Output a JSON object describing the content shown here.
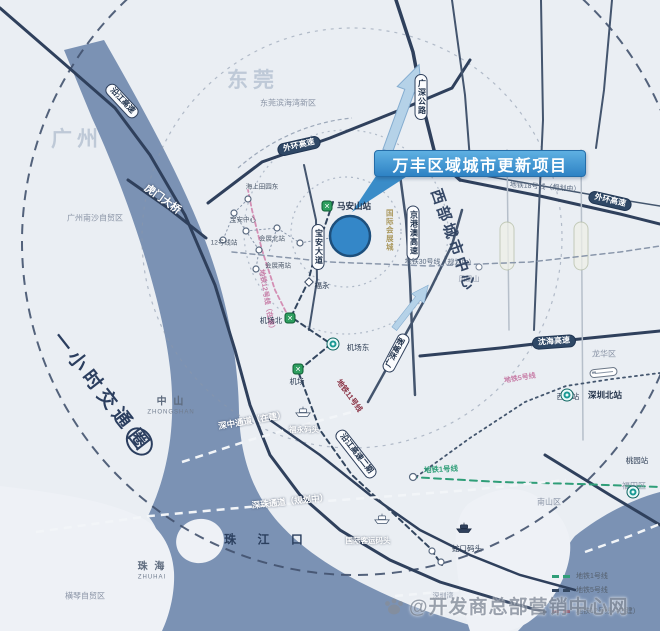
{
  "banner": {
    "title": "万丰区域城市更新项目"
  },
  "hour_circle": {
    "prefix": "一小时交通",
    "circled": "圈"
  },
  "legend": {
    "items": [
      {
        "label": "地铁1号线",
        "color": "#2f9e78"
      },
      {
        "label": "地铁5号线",
        "color": "#33465f"
      },
      {
        "label": "地铁12号线（在建）",
        "color": "#8a5a70"
      }
    ]
  },
  "watermark": {
    "text": "@开发商总部营销中心网",
    "icon": "baidu-paw-icon"
  },
  "palette": {
    "water": "#7b92b4",
    "land": "#eaeef3",
    "road": "#2f405c",
    "banner_blue": "#2e82c4",
    "project_circle_blue": "#3487c8",
    "metro_green": "#2e9e5f",
    "metro_teal": "#1a9a94",
    "line1_green": "#2f9e78",
    "line5_navy": "#33465f",
    "line11_maroon": "#8a3244",
    "line12_pink": "#d48fb4"
  },
  "map_labels": [
    {
      "name": "label-yanjiang-expressway",
      "text": "沿江高速",
      "x": 122,
      "y": 101,
      "rot": 47,
      "cls": "pillw"
    },
    {
      "name": "label-guangshen-highway",
      "text": "广深公路",
      "x": 421,
      "y": 97,
      "rot": 0,
      "cls": "pillv"
    },
    {
      "name": "label-jinggangao-expressway",
      "text": "京港澳高速",
      "x": 413,
      "y": 233,
      "rot": 0,
      "cls": "pillv"
    },
    {
      "name": "label-baoan-avenue",
      "text": "宝安大道",
      "x": 318,
      "y": 247,
      "rot": 0,
      "cls": "pillv"
    },
    {
      "name": "label-guangshen-expressway",
      "text": "广深高速",
      "x": 396,
      "y": 353,
      "rot": -62,
      "cls": "pillw"
    },
    {
      "name": "label-yanjiang-expressway-phase2",
      "text": "沿江高速二期",
      "x": 356,
      "y": 454,
      "rot": 52,
      "cls": "pillw"
    },
    {
      "name": "label-outer-ring-expressway-west",
      "text": "外环高速",
      "x": 299,
      "y": 146,
      "rot": -13,
      "cls": "pilld"
    },
    {
      "name": "label-outer-ring-expressway-east",
      "text": "外环高速",
      "x": 610,
      "y": 201,
      "rot": 13,
      "cls": "pilld"
    },
    {
      "name": "label-shenhai-expressway",
      "text": "沈海高速",
      "x": 554,
      "y": 342,
      "rot": -4,
      "cls": "pilld"
    },
    {
      "name": "label-humen-bridge",
      "text": "虎门大桥",
      "x": 162,
      "y": 200,
      "rot": 36,
      "cls": "wtext"
    },
    {
      "name": "label-shenzhong-corridor",
      "text": "深中通道（在建）",
      "x": 252,
      "y": 421,
      "rot": -10,
      "cls": "wtext-sm"
    },
    {
      "name": "label-shenzhu-corridor",
      "text": "深珠通道（规划中）",
      "x": 290,
      "y": 502,
      "rot": -6,
      "cls": "wtext-sm"
    },
    {
      "name": "label-fuyong-ferry",
      "text": "福永码头",
      "x": 304,
      "y": 430,
      "rot": 0,
      "cls": "wtext-xs"
    },
    {
      "name": "label-intl-ferry-terminal",
      "text": "国际客运码头",
      "x": 368,
      "y": 541,
      "rot": 0,
      "cls": "wtext-xs"
    },
    {
      "name": "label-pearl-river-estuary",
      "text": "珠 江 口",
      "x": 268,
      "y": 540,
      "rot": 0,
      "cls": "estuary"
    },
    {
      "name": "label-dongguan",
      "text": "东莞",
      "x": 253,
      "y": 81,
      "rot": 0,
      "cls": "citywm"
    },
    {
      "name": "label-guangzhou",
      "text": "广州",
      "x": 77,
      "y": 140,
      "rot": 0,
      "cls": "citywm"
    },
    {
      "name": "label-dg-binhaiwan-new-area",
      "text": "东莞滨海湾新区",
      "x": 288,
      "y": 104,
      "rot": 0,
      "cls": "region"
    },
    {
      "name": "label-gz-nansha-ftz",
      "text": "广州南沙自贸区",
      "x": 95,
      "y": 219,
      "rot": 0,
      "cls": "region"
    },
    {
      "name": "label-nanshan-district",
      "text": "南山区",
      "x": 549,
      "y": 503,
      "rot": 0,
      "cls": "region"
    },
    {
      "name": "label-futian-district",
      "text": "福田区",
      "x": 634,
      "y": 487,
      "rot": 0,
      "cls": "region"
    },
    {
      "name": "label-longhua-district",
      "text": "龙华区",
      "x": 604,
      "y": 355,
      "rot": 0,
      "cls": "region"
    },
    {
      "name": "label-hengqin-ftz",
      "text": "横琴自贸区",
      "x": 85,
      "y": 597,
      "rot": 0,
      "cls": "region"
    },
    {
      "name": "label-shenzhen-bay",
      "text": "深圳湾",
      "x": 443,
      "y": 597,
      "rot": 0,
      "cls": "region-xs"
    },
    {
      "name": "label-fenghuang-mountain",
      "text": "凤凰山",
      "x": 469,
      "y": 280,
      "rot": 0,
      "cls": "region-xs"
    },
    {
      "name": "label-zhongshan",
      "text": "中 山",
      "x": 171,
      "y": 402,
      "rot": 0,
      "cls": "city"
    },
    {
      "name": "label-zhongshan-en",
      "text": "ZHONGSHAN",
      "x": 171,
      "y": 413,
      "rot": 0,
      "cls": "city-sub"
    },
    {
      "name": "label-zhuhai",
      "text": "珠 海",
      "x": 152,
      "y": 567,
      "rot": 0,
      "cls": "city"
    },
    {
      "name": "label-zhuhai-en",
      "text": "ZHUHAI",
      "x": 152,
      "y": 578,
      "rot": 0,
      "cls": "city-sub"
    },
    {
      "name": "label-metro-line18",
      "text": "地铁18号线（规划中）",
      "x": 545,
      "y": 188,
      "rot": 4,
      "cls": "mline"
    },
    {
      "name": "label-metro-line30",
      "text": "地铁30号线（规划中）",
      "x": 440,
      "y": 263,
      "rot": 1,
      "cls": "mline"
    },
    {
      "name": "label-west-city-center",
      "text": "西部城市中心",
      "x": 452,
      "y": 241,
      "rot": 71,
      "cls": "bignavy"
    },
    {
      "name": "label-metro-line12",
      "text": "地铁12号线（在建）",
      "x": 266,
      "y": 301,
      "rot": 80,
      "cls": "mpink"
    },
    {
      "name": "label-metro-line11",
      "text": "地铁11号线",
      "x": 349,
      "y": 396,
      "rot": 54,
      "cls": "mmaroon"
    },
    {
      "name": "label-metro-line5",
      "text": "地铁5号线",
      "x": 520,
      "y": 379,
      "rot": -9,
      "cls": "mpink"
    },
    {
      "name": "label-metro-line1",
      "text": "地铁1号线",
      "x": 441,
      "y": 470,
      "rot": -3,
      "cls": "mgreen"
    },
    {
      "name": "label-maanshan-station",
      "text": "马安山站",
      "x": 354,
      "y": 207,
      "rot": 0,
      "cls": "sta-b"
    },
    {
      "name": "label-fuyong-station",
      "text": "福永",
      "x": 322,
      "y": 286,
      "rot": 0,
      "cls": "sta"
    },
    {
      "name": "label-airport-north-station",
      "text": "机场北",
      "x": 271,
      "y": 321,
      "rot": 0,
      "cls": "sta"
    },
    {
      "name": "label-airport-east-station",
      "text": "机场东",
      "x": 358,
      "y": 348,
      "rot": 0,
      "cls": "sta"
    },
    {
      "name": "label-airport-station",
      "text": "机场",
      "x": 297,
      "y": 382,
      "rot": 0,
      "cls": "sta"
    },
    {
      "name": "label-xili-station",
      "text": "西丽站",
      "x": 568,
      "y": 397,
      "rot": 0,
      "cls": "sta"
    },
    {
      "name": "label-shenzhen-north-station",
      "text": "深圳北站",
      "x": 605,
      "y": 396,
      "rot": 0,
      "cls": "sta-b"
    },
    {
      "name": "label-taoyuan-station",
      "text": "桃园站",
      "x": 637,
      "y": 461,
      "rot": 0,
      "cls": "sta"
    },
    {
      "name": "label-shekou-ferry",
      "text": "蛇口码头",
      "x": 467,
      "y": 549,
      "rot": 0,
      "cls": "sta"
    },
    {
      "name": "label-haishang-tianyuan-east",
      "text": "海上田园东",
      "x": 262,
      "y": 187,
      "rot": 0,
      "cls": "sta-xs"
    },
    {
      "name": "label-huizhan-north-station",
      "text": "会展北站",
      "x": 272,
      "y": 239,
      "rot": 0,
      "cls": "sta-xs"
    },
    {
      "name": "label-huizhan-south-station",
      "text": "会展南站",
      "x": 278,
      "y": 266,
      "rot": 0,
      "cls": "sta-xs"
    },
    {
      "name": "label-baoan-center",
      "text": "宝安中心",
      "x": 243,
      "y": 220,
      "rot": 0,
      "cls": "sta-xs"
    },
    {
      "name": "label-line12-station",
      "text": "12号线站",
      "x": 224,
      "y": 243,
      "rot": 0,
      "cls": "sta-xs"
    },
    {
      "name": "label-intl-convention-city",
      "text": "国际会展城",
      "x": 389,
      "y": 230,
      "rot": 0,
      "cls": "tanv"
    }
  ],
  "map_icons": [
    {
      "name": "maanshan-metro-icon",
      "type": "metro-green",
      "x": 327,
      "y": 206
    },
    {
      "name": "airport-north-metro-icon",
      "type": "metro-green",
      "x": 290,
      "y": 318
    },
    {
      "name": "airport-metro-icon",
      "type": "metro-green",
      "x": 298,
      "y": 369
    },
    {
      "name": "airport-east-metro-icon",
      "type": "metro-teal",
      "x": 333,
      "y": 344
    },
    {
      "name": "xili-metro-icon",
      "type": "metro-teal",
      "x": 567,
      "y": 384
    },
    {
      "name": "taoyuan-metro-icon",
      "type": "metro-teal",
      "x": 633,
      "y": 470
    },
    {
      "name": "fuyong-station-icon",
      "type": "diamond",
      "x": 309,
      "y": 282
    },
    {
      "name": "fenghuang-mountain-icon",
      "type": "ring",
      "x": 479,
      "y": 267
    },
    {
      "name": "fuyong-ferry-icon",
      "type": "ferry-white",
      "x": 303,
      "y": 414
    },
    {
      "name": "intl-ferry-icon",
      "type": "ferry-white",
      "x": 382,
      "y": 521
    },
    {
      "name": "shekou-ferry-icon",
      "type": "ferry-dark",
      "x": 464,
      "y": 530
    },
    {
      "name": "shenzhen-north-train-icon",
      "type": "train",
      "x": 604,
      "y": 375
    }
  ]
}
